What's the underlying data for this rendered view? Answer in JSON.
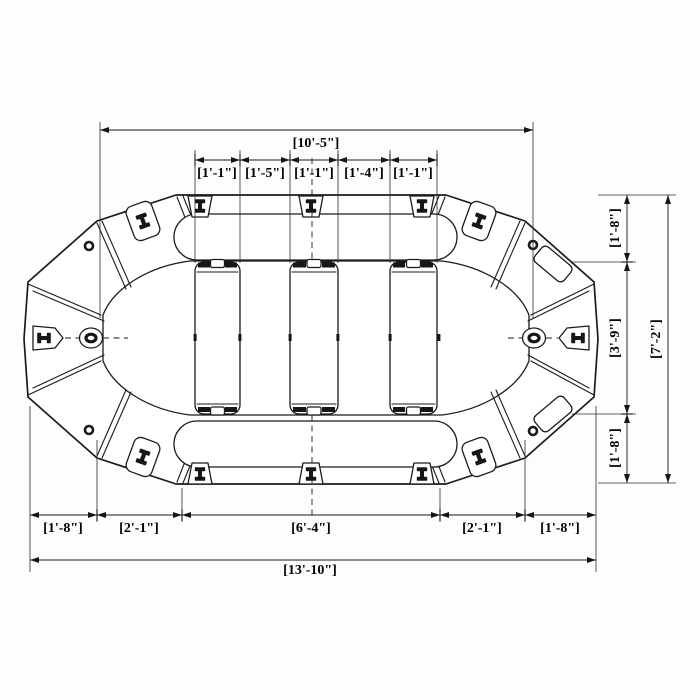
{
  "drawing": {
    "title": "inflatable-raft-top-view-technical-drawing",
    "background_color": "#fdfdfd",
    "line_color": "#1b1b1b",
    "text_color": "#000000",
    "dimensions": {
      "top_overall": "[10'-5\"]",
      "thwart_row": [
        "[1'-1\"]",
        "[1'-5\"]",
        "[1'-1\"]",
        "[1'-4\"]",
        "[1'-1\"]"
      ],
      "right_segments": [
        "[1'-8\"]",
        "[3'-9\"]",
        "[1'-8\"]"
      ],
      "right_overall": "[7'-2\"]",
      "bottom_segments": [
        "[1'-8\"]",
        "[2'-1\"]",
        "[6'-4\"]",
        "[2'-1\"]",
        "[1'-8\"]"
      ],
      "bottom_overall": "[13'-10\"]"
    }
  }
}
